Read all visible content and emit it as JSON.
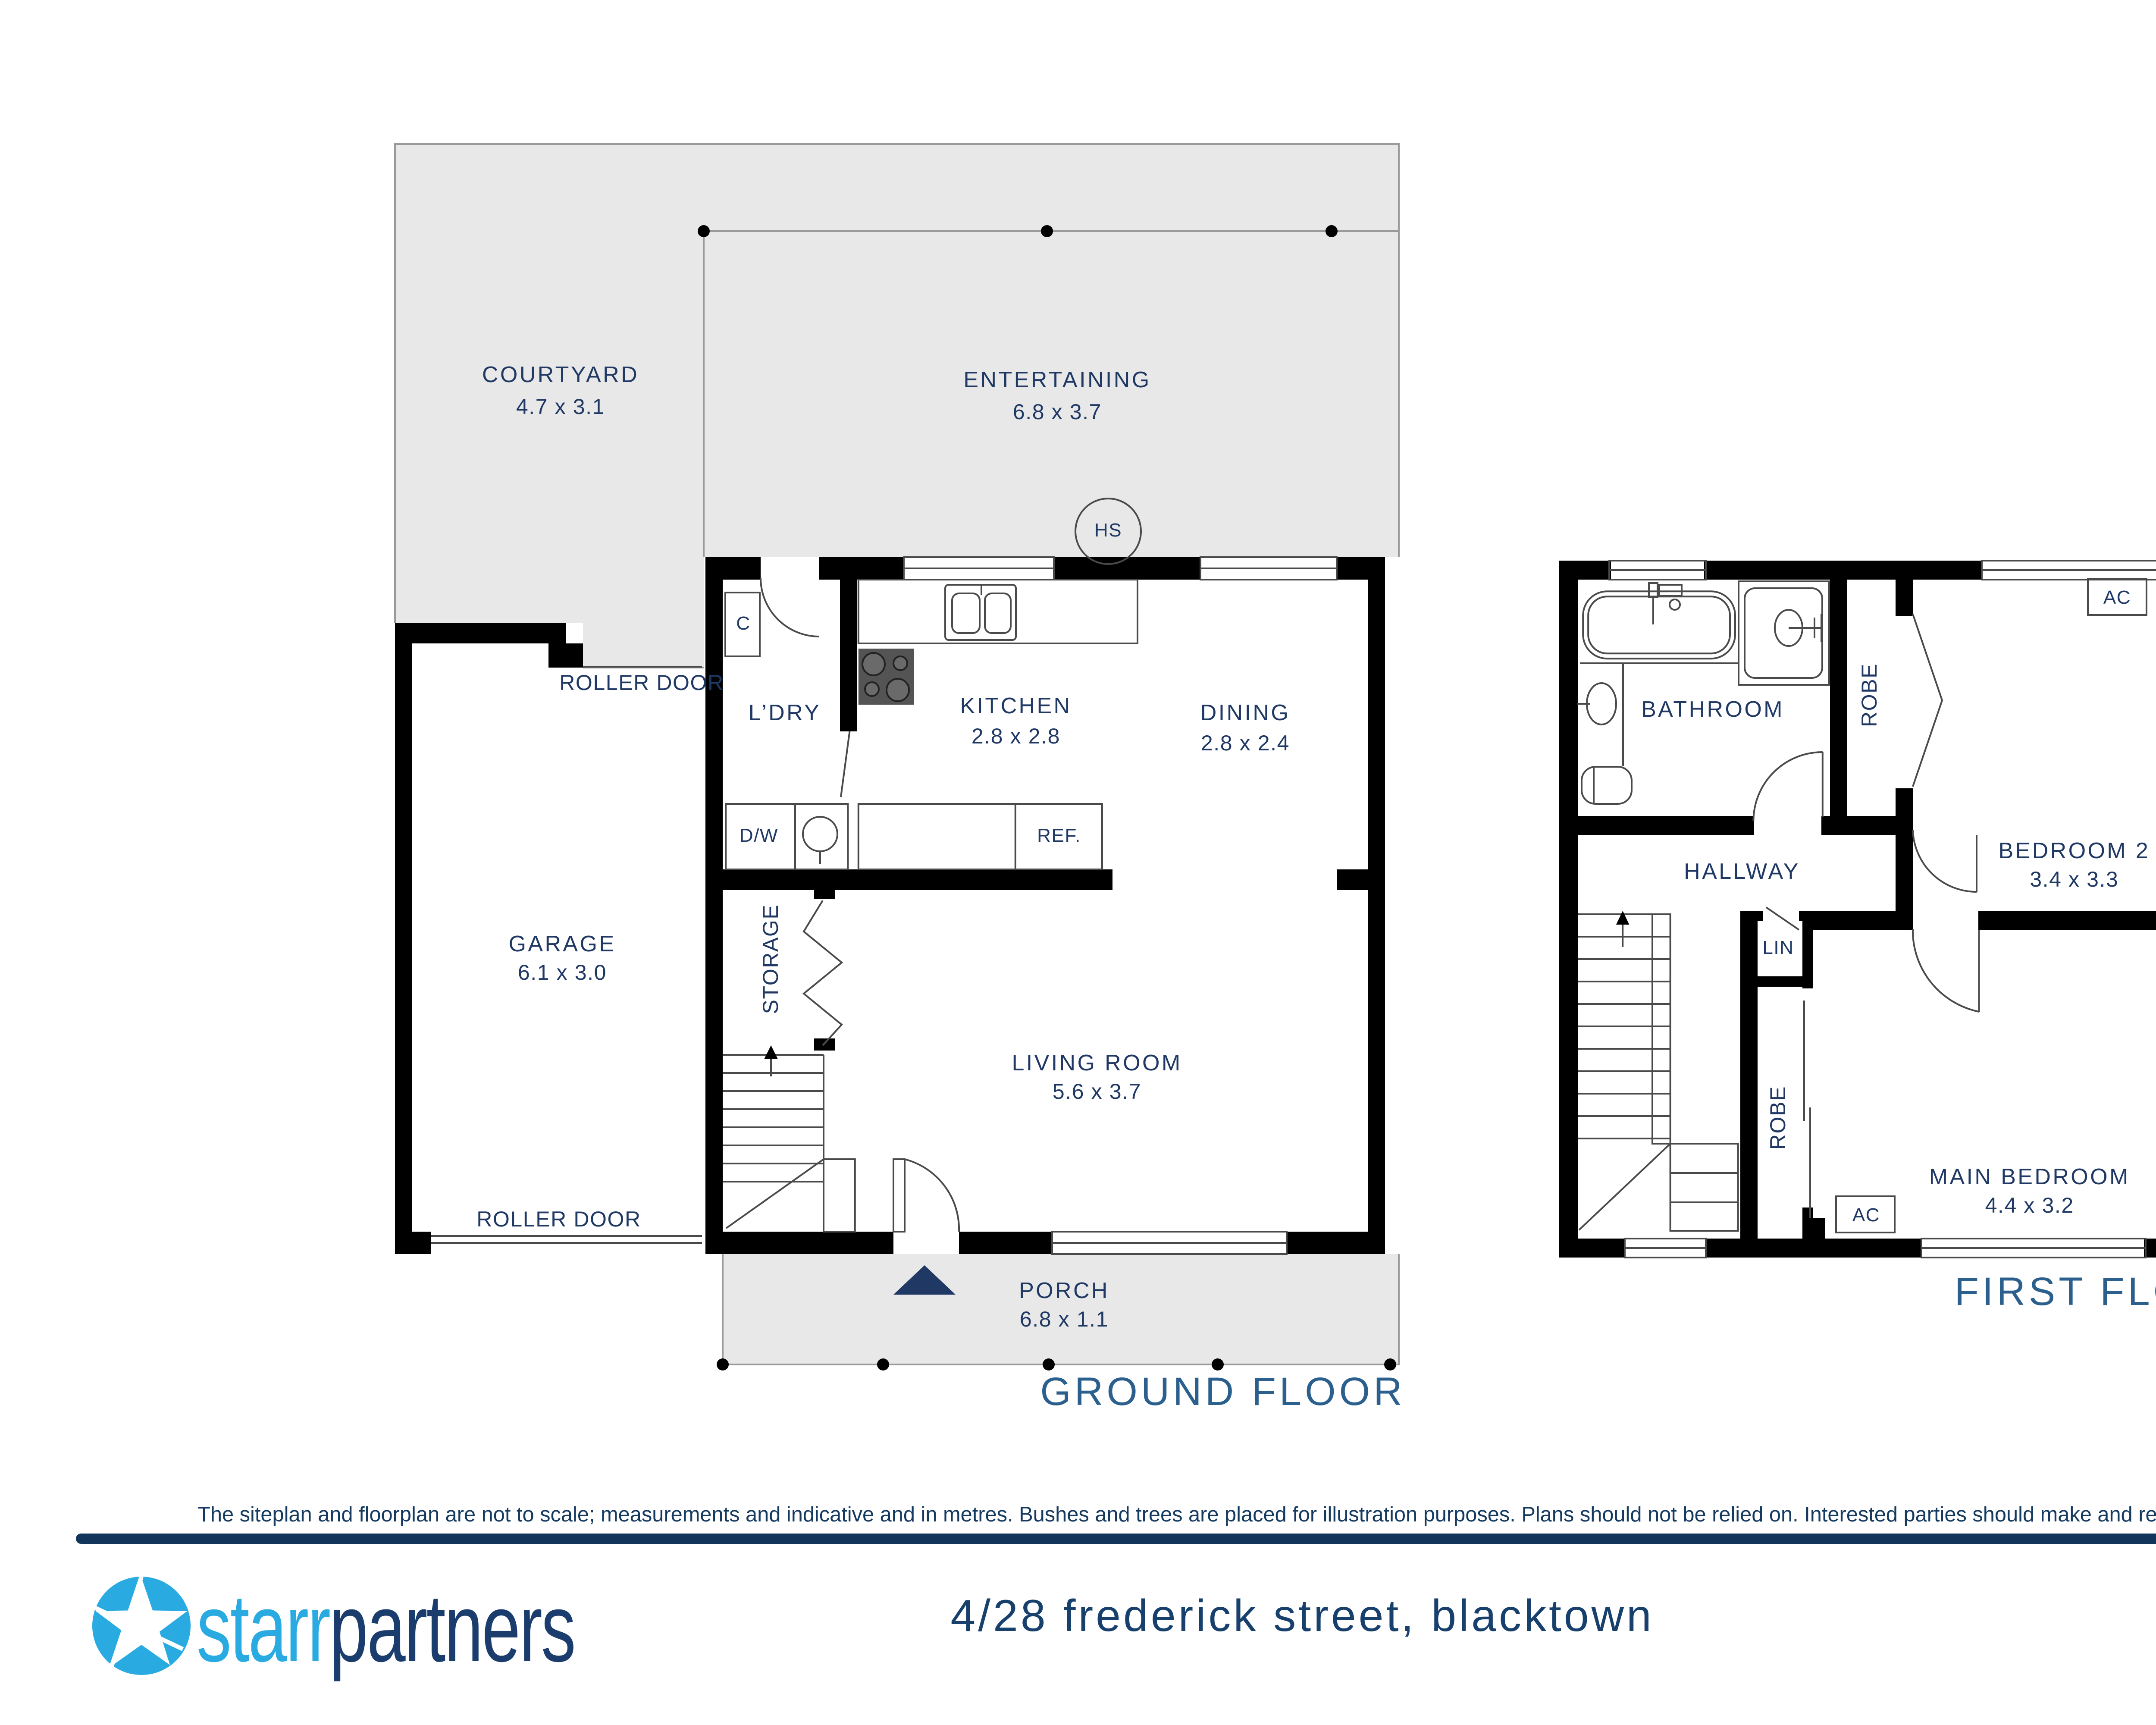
{
  "gf": {
    "title": "GROUND FLOOR",
    "courtyard": {
      "name": "COURTYARD",
      "dims": "4.7 x 3.1"
    },
    "entertaining": {
      "name": "ENTERTAINING",
      "dims": "6.8 x 3.7"
    },
    "kitchen": {
      "name": "KITCHEN",
      "dims": "2.8 x 2.8"
    },
    "dining": {
      "name": "DINING",
      "dims": "2.8 x 2.4"
    },
    "garage": {
      "name": "GARAGE",
      "dims": "6.1 x 3.0"
    },
    "living": {
      "name": "LIVING ROOM",
      "dims": "5.6 x 3.7"
    },
    "porch": {
      "name": "PORCH",
      "dims": "6.8 x 1.1"
    },
    "laundry": "L’DRY",
    "storage": "STORAGE",
    "closet": "C",
    "dishwasher": "D/W",
    "fridge": "REF.",
    "hot_system": "HS",
    "roller_door": "ROLLER DOOR"
  },
  "ff": {
    "title": "FIRST FLOOR",
    "bathroom": "BATHROOM",
    "bedroom2": {
      "name": "BEDROOM 2",
      "dims": "3.4 x 3.3"
    },
    "main_bedroom": {
      "name": "MAIN BEDROOM",
      "dims": "4.4 x 3.2"
    },
    "hallway": "HALLWAY",
    "robe": "ROBE",
    "linen": "LIN",
    "ac": "AC"
  },
  "compass": {
    "north": "N"
  },
  "footer": {
    "disclaimer": "The siteplan and floorplan are not to scale; measurements and indicative and in metres. Bushes and trees are placed for illustration purposes. Plans should not be relied on. Interested parties should make and rely on their own enquiries.",
    "brand_starr": "starr",
    "brand_partners": "partners",
    "address": "4/28 frederick street, blacktown"
  },
  "colors": {
    "wall": "#000000",
    "room_label_navy": "#1F3864",
    "floor_title_blue": "#2B5F8D",
    "footer_bar_navy": "#12365B",
    "logo_cyan": "#29ABE2",
    "logo_navy": "#1B3D6E",
    "plan_gray": "#E8E8E8",
    "compass_dark": "#17365D",
    "compass_light": "#C5CEE6"
  }
}
